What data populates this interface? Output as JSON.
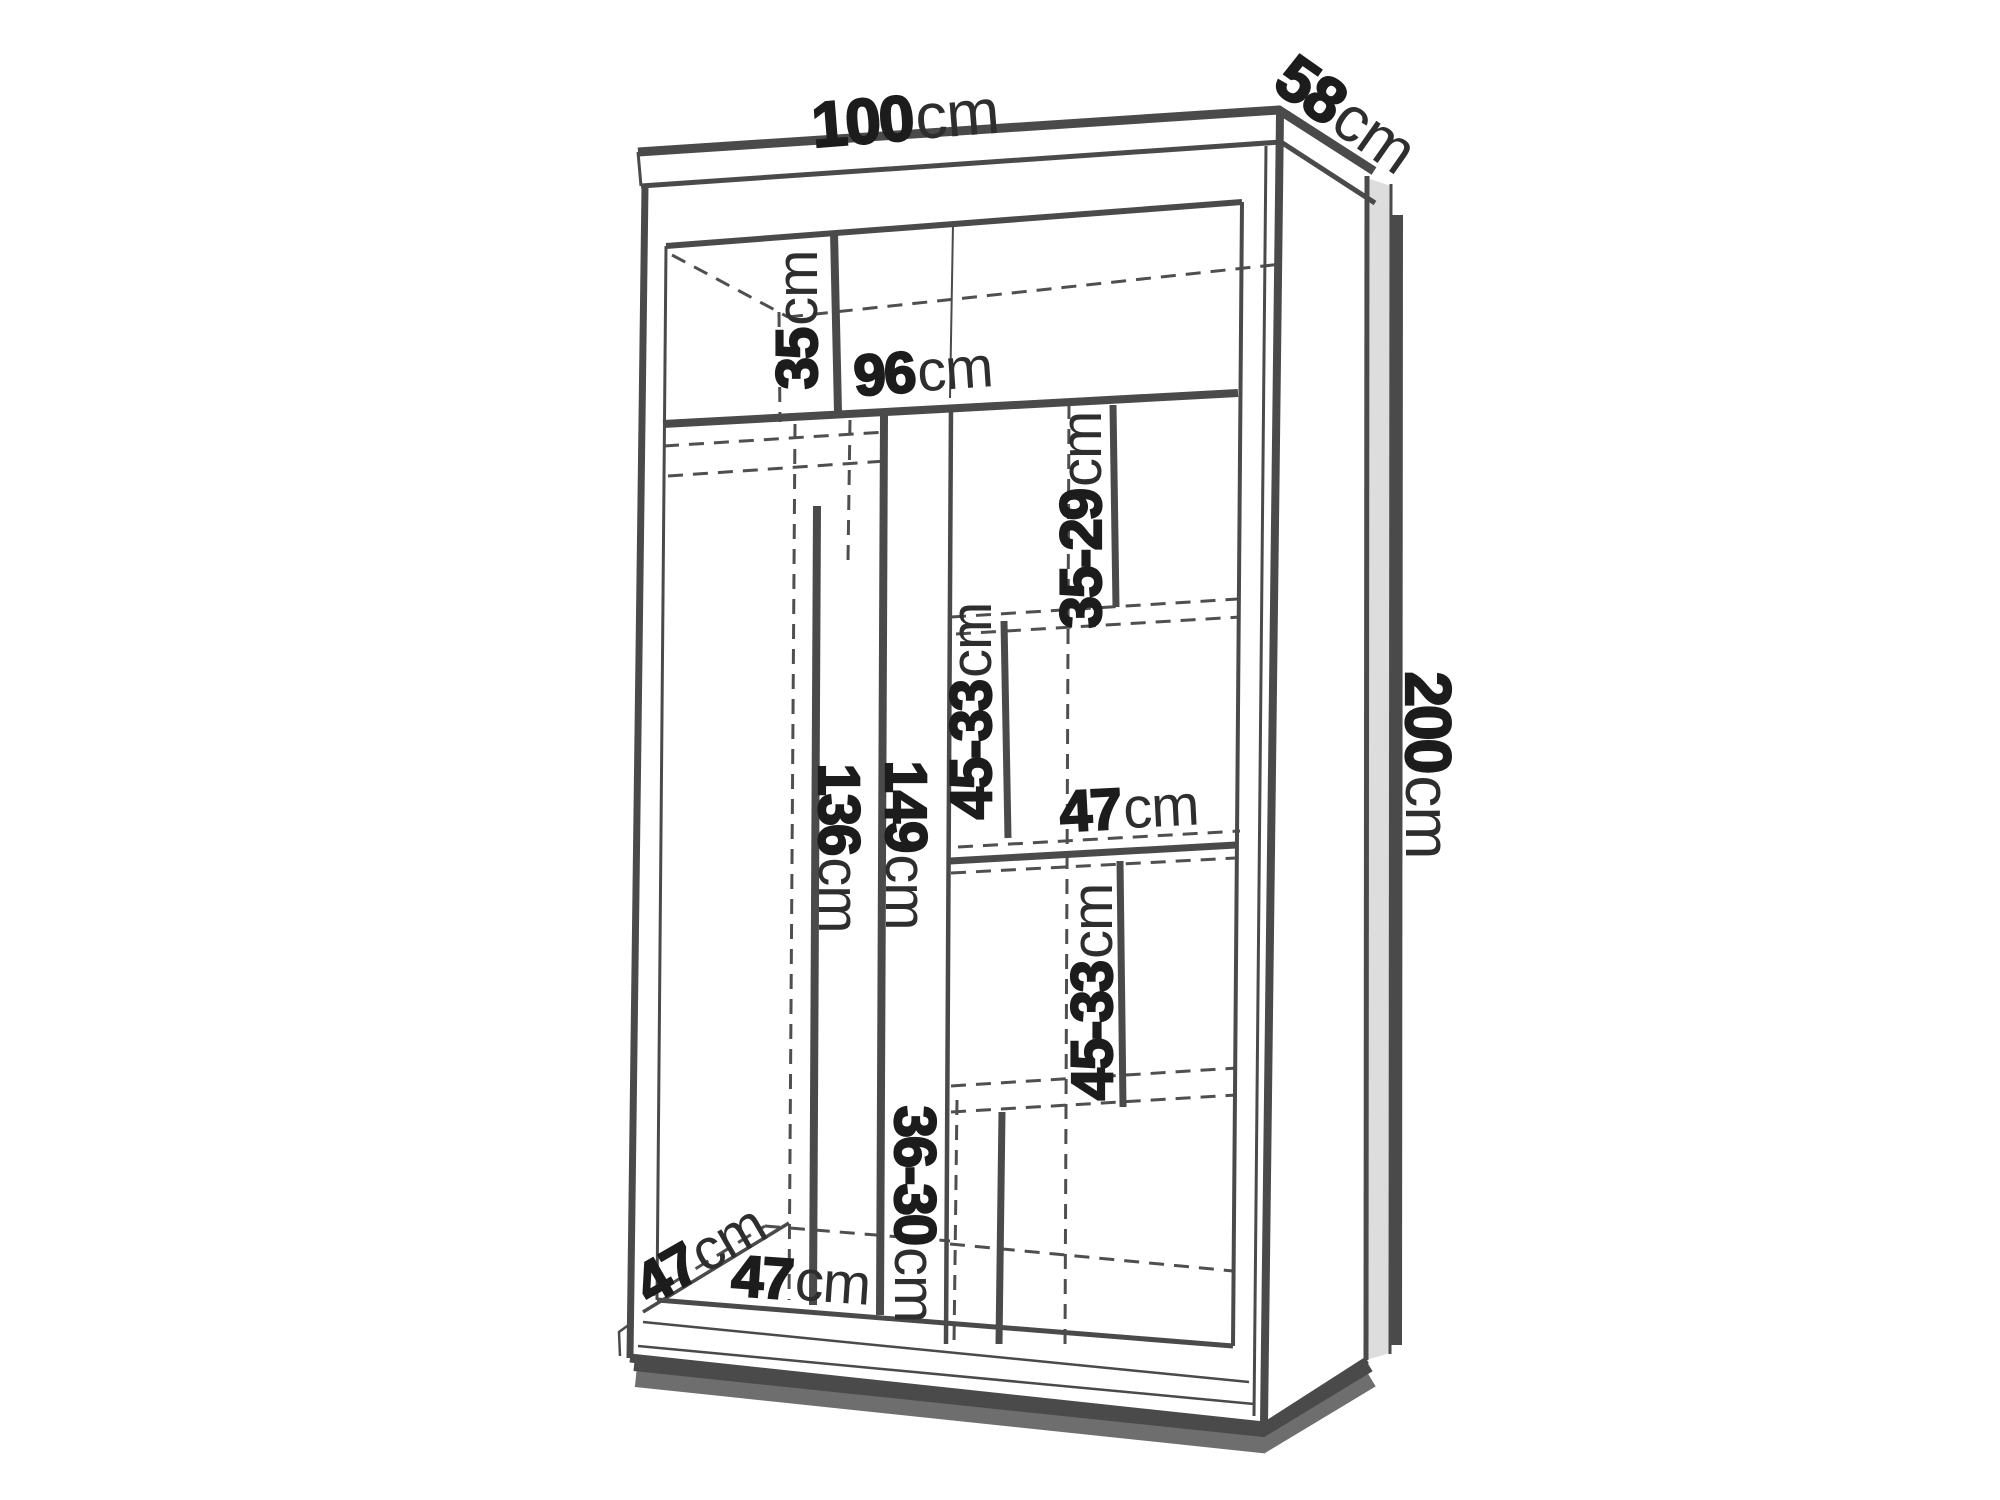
{
  "diagram": {
    "kind": "furniture-dimension-line-drawing",
    "subject": "two-door sliding wardrobe shown in perspective with interior shelves, hanging section and dashed depth projection lines",
    "unit": "cm",
    "colors": {
      "background": "#ffffff",
      "line": "#4a4a4a",
      "text": "#1c1c1c",
      "shadow": "#d7d7d7"
    },
    "overall_dimensions": {
      "width": "100",
      "depth": "58",
      "height": "200"
    },
    "labels": [
      {
        "value": "100",
        "unit": "cm"
      },
      {
        "value": "58",
        "unit": "cm"
      },
      {
        "value": "200",
        "unit": "cm"
      },
      {
        "value": "35",
        "unit": "cm"
      },
      {
        "value": "96",
        "unit": "cm"
      },
      {
        "value": "35-29",
        "unit": "cm"
      },
      {
        "value": "45-33",
        "unit": "cm"
      },
      {
        "value": "47",
        "unit": "cm"
      },
      {
        "value": "136",
        "unit": "cm"
      },
      {
        "value": "149",
        "unit": "cm"
      },
      {
        "value": "45-33",
        "unit": "cm"
      },
      {
        "value": "36-30",
        "unit": "cm"
      },
      {
        "value": "47",
        "unit": "cm"
      },
      {
        "value": "47",
        "unit": "cm"
      }
    ]
  }
}
